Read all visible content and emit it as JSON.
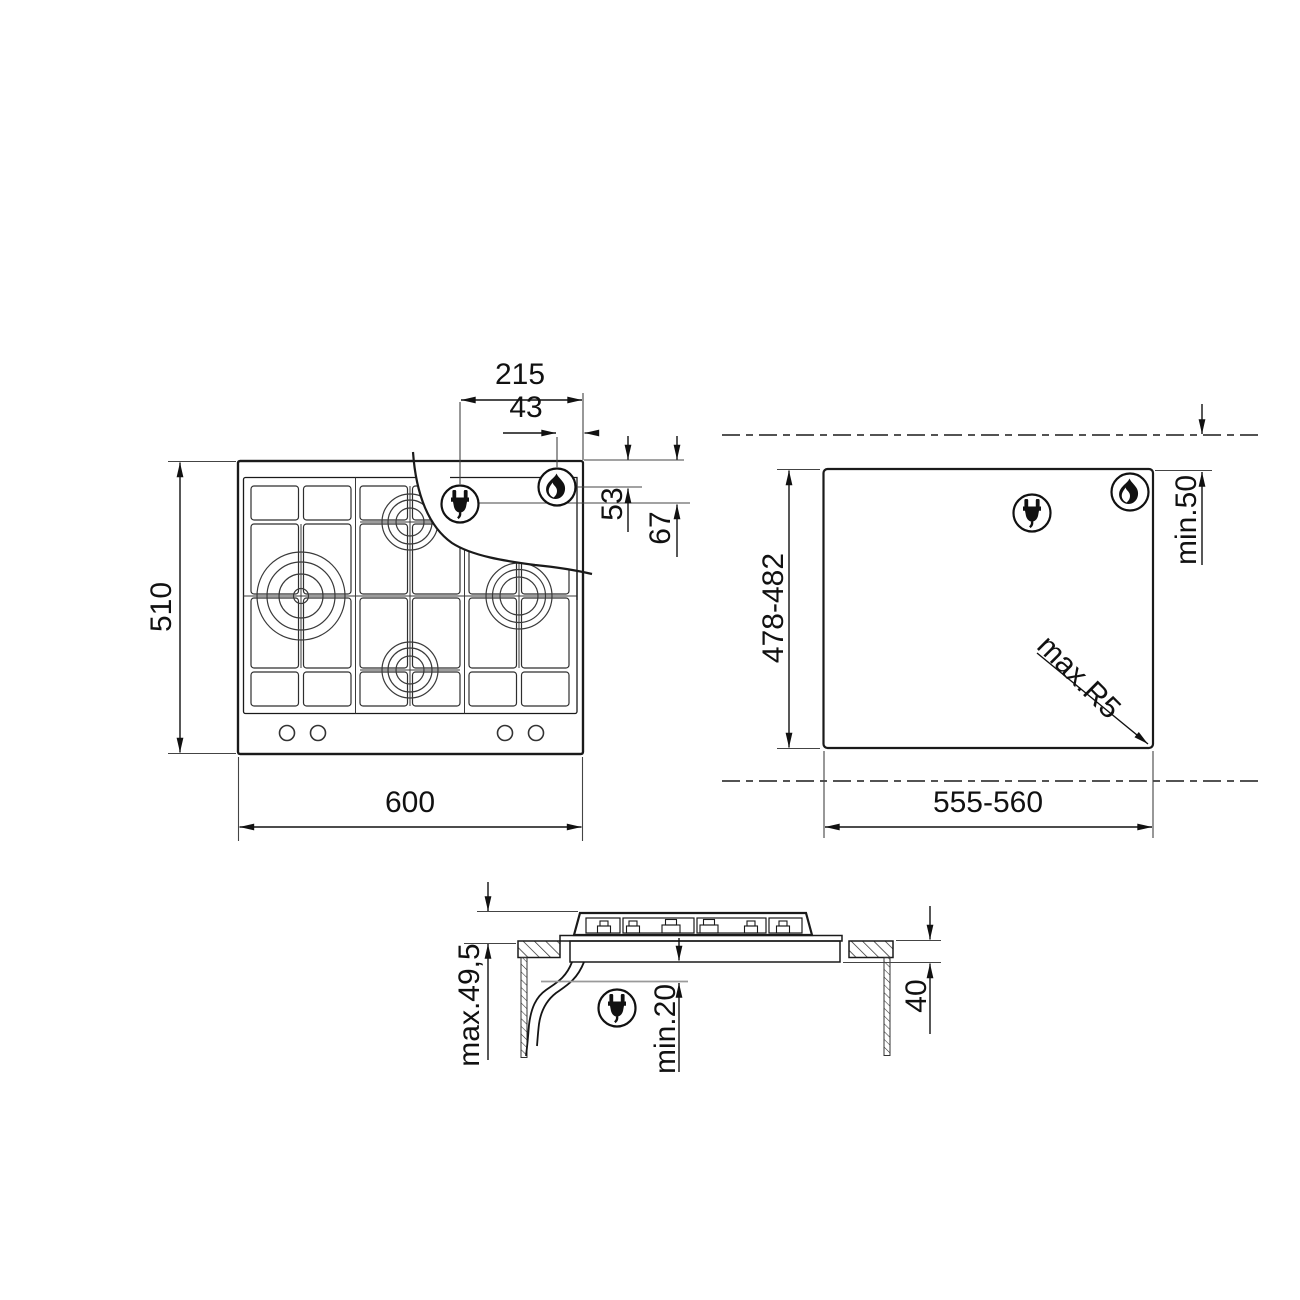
{
  "diagram_title": "Gas hob installation drawing",
  "views": {
    "hob_top": {
      "name": "hob top view",
      "dims": {
        "depth": "510",
        "width": "600",
        "plug_offset_x": "215",
        "flame_offset_x": "43",
        "flame_offset_y": "53",
        "plug_offset_y": "67"
      }
    },
    "cutout": {
      "name": "worktop cutout view",
      "dims": {
        "depth": "478-482",
        "width": "555-560",
        "rear_clearance": "min.50",
        "corner_radius": "max.R5"
      }
    },
    "side": {
      "name": "side section view",
      "dims": {
        "hob_height": "max.49,5",
        "bottom_clearance": "min.20",
        "worktop_thickness": "40"
      }
    }
  },
  "icons": {
    "plug": "power-plug-icon",
    "flame": "gas-flame-icon"
  },
  "colors": {
    "line": "#1a1a1a",
    "text": "#111111",
    "reference_gray": "#9a9a9a",
    "background": "#ffffff"
  }
}
